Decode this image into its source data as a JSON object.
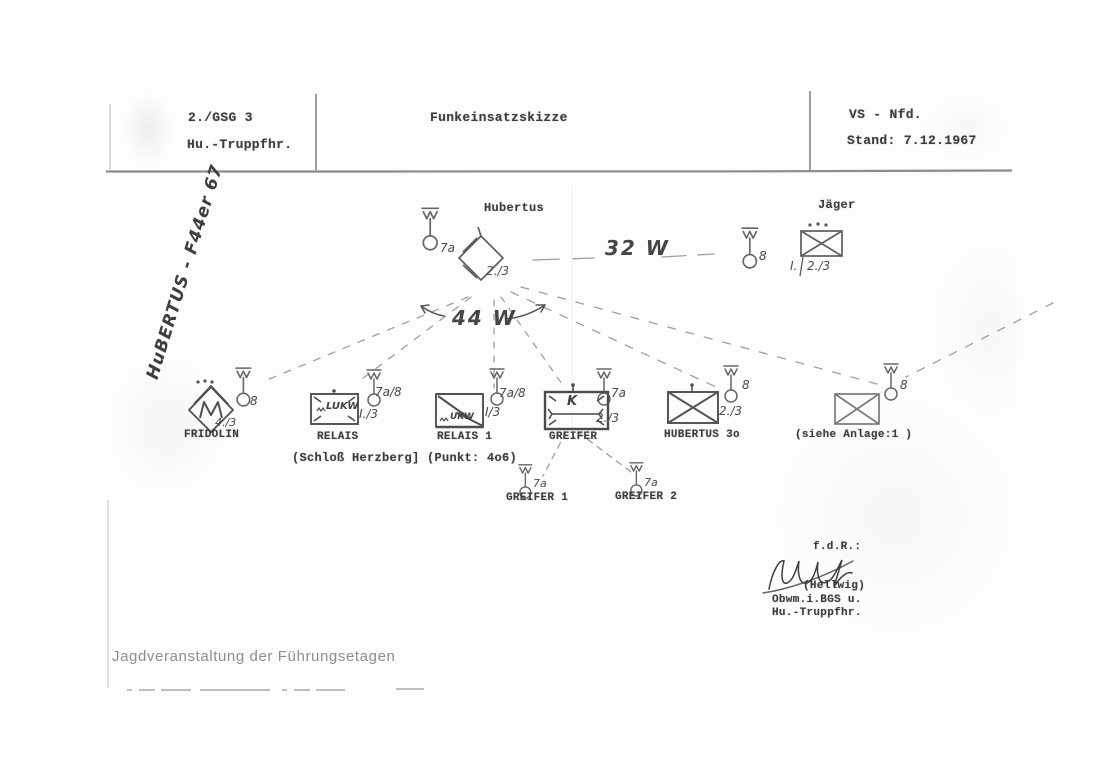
{
  "document": {
    "header": {
      "unit": "2./GSG 3",
      "role": "Hu.-Truppfhr.",
      "title": "Funkeinsatzskizze",
      "classification": "VS - Nfd.",
      "status": "Stand: 7.12.1967"
    },
    "handwritten_note_rotated": "HuBERTUS - F44er 67",
    "links": {
      "hubertus_jaeger_power": "32 W",
      "net_power": "44 W"
    },
    "location_note": "(Schloß Herzberg] (Punkt: 4o6)",
    "stations": {
      "hubertus": {
        "name": "Hubertus",
        "antenna": "7a",
        "unit": "2./3"
      },
      "jaeger": {
        "name": "Jäger",
        "antenna": "8",
        "unit_prefix": "I.",
        "unit": "2./3"
      },
      "fridolin": {
        "name": "FRIDOLIN",
        "antenna": "8",
        "unit": "4./3"
      },
      "relais": {
        "name": "RELAIS",
        "antenna": "7a/8",
        "unit": "I./3",
        "box_text": "LUKW"
      },
      "relais1": {
        "name": "RELAIS 1",
        "antenna": "7a/8",
        "unit": "I/3",
        "box_text": "UKW"
      },
      "greifer": {
        "name": "GREIFER",
        "antenna": "7a",
        "unit": "2./3",
        "box_text": "K"
      },
      "hubertus30": {
        "name": "HUBERTUS 3o",
        "antenna": "8",
        "unit": "2./3"
      },
      "anlage": {
        "name": "(siehe Anlage:1 )",
        "antenna": "8"
      },
      "greifer1": {
        "name": "GREIFER 1",
        "antenna": "7a"
      },
      "greifer2": {
        "name": "GREIFER 2",
        "antenna": "7a"
      }
    },
    "signature": {
      "fdr": "f.d.R.:",
      "name": "(Hellwig)",
      "line1": "Obwm.i.BGS u.",
      "line2": "Hu.-Truppfhr."
    },
    "caption": "Jagdveranstaltung der Führungsetagen",
    "icons": {
      "antenna": "mast-with-zigzag-and-circle",
      "radio_wave": "small-zigzag",
      "crossed_box": "rectangle-with-X",
      "diamond": "rotated-square"
    },
    "colors": {
      "typed_ink": "#3d3d3d",
      "pencil": "#6b6b6b",
      "caption_gray": "#8e8e8e",
      "paper": "#fdfdfc"
    }
  }
}
